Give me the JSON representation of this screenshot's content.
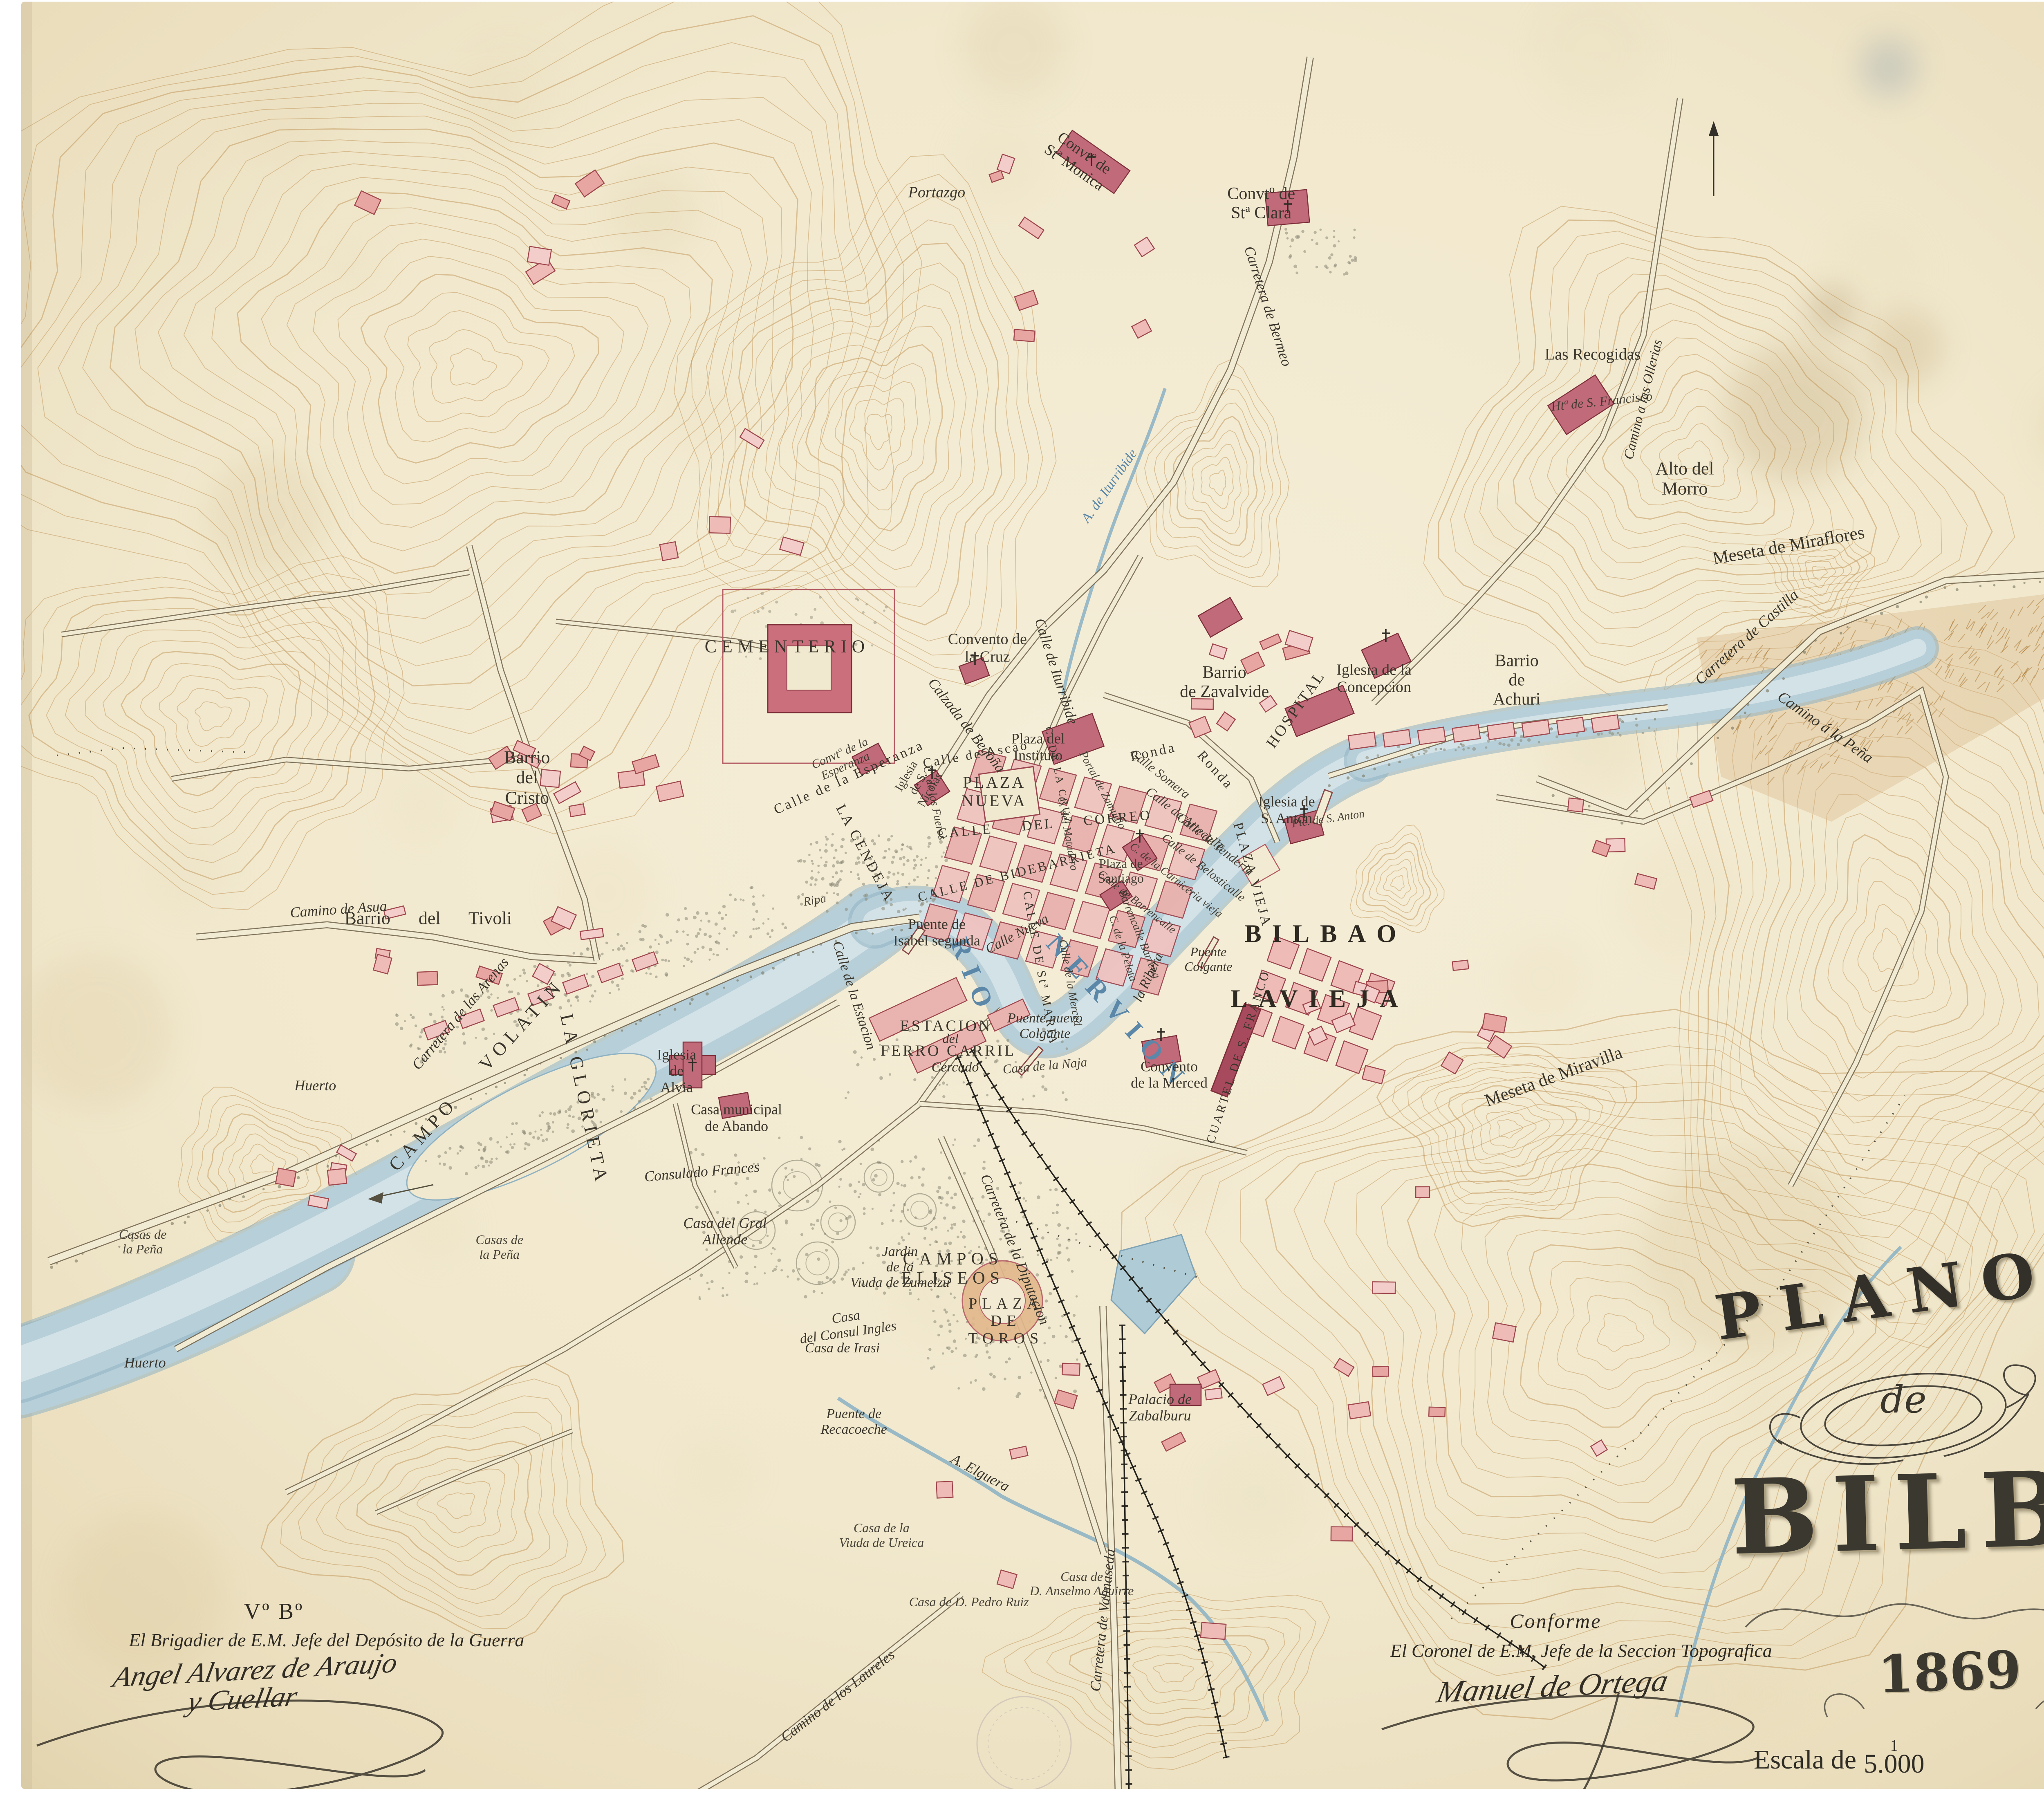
{
  "title_block": {
    "line1": "PLANO",
    "line2": "de",
    "line3": "BILBAO",
    "year": "1869"
  },
  "scale": {
    "label": "Escala de",
    "numerator": "1",
    "denominator": "5.000",
    "equidistance": "Equidistancia 3 Ms."
  },
  "approvals": {
    "left": {
      "visto_bueno": "Vº Bº",
      "role": "El Brigadier de E.M. Jefe del Depósito de la Guerra",
      "signature_line1": "Angel Alvarez de Araujo",
      "signature_line2": "y Cuellar"
    },
    "right": {
      "heading": "Conforme",
      "role": "El Coronel de E.M. Jefe de la Seccion Topografica",
      "signature": "Manuel de Ortega"
    }
  },
  "colors": {
    "paper": "#f1e9cf",
    "contour": "#bf9356",
    "water": "#b7cfd9",
    "building_light": "#f0c6c2",
    "building_dark": "#c06a7a",
    "ink": "#3a362c",
    "river_label": "#5b87a8"
  },
  "map_labels": [
    {
      "text": "CEMENTERIO",
      "x": 34.2,
      "y": 35.9,
      "rot": 0,
      "cls": "caps",
      "fs": 44
    },
    {
      "text": "Convento de\nla Cruz",
      "x": 42.9,
      "y": 36.0,
      "rot": 0,
      "cls": "roman",
      "fs": 38
    },
    {
      "text": "Calzada de Begoña",
      "x": 42.0,
      "y": 40.3,
      "rot": 52,
      "cls": "it",
      "fs": 36
    },
    {
      "text": "Calle de Iturribide",
      "x": 45.9,
      "y": 37.3,
      "rot": 72,
      "cls": "it",
      "fs": 36
    },
    {
      "text": "Barrio\nde Zavalvide",
      "x": 53.2,
      "y": 37.9,
      "rot": 0,
      "cls": "roman",
      "fs": 42
    },
    {
      "text": "Iglesia de la\nConcepcion",
      "x": 59.7,
      "y": 37.7,
      "rot": 0,
      "cls": "roman",
      "fs": 38
    },
    {
      "text": "HOSPITAL",
      "x": 56.3,
      "y": 39.4,
      "rot": -55,
      "cls": "caps-sm",
      "fs": 38
    },
    {
      "text": "Barrio\nde\nAchuri",
      "x": 65.9,
      "y": 37.8,
      "rot": 0,
      "cls": "roman",
      "fs": 42
    },
    {
      "text": "Carretera de Castilla",
      "x": 75.9,
      "y": 35.4,
      "rot": -42,
      "cls": "it",
      "fs": 38
    },
    {
      "text": "Camino á la Peña",
      "x": 79.3,
      "y": 40.4,
      "rot": 35,
      "cls": "it",
      "fs": 38
    },
    {
      "text": "Alto del\nMorro",
      "x": 73.2,
      "y": 26.6,
      "rot": 0,
      "cls": "roman",
      "fs": 44
    },
    {
      "text": "Meseta de Miraflores",
      "x": 77.7,
      "y": 30.3,
      "rot": -10,
      "cls": "roman",
      "fs": 44
    },
    {
      "text": "Meseta de Miravilla",
      "x": 67.5,
      "y": 59.8,
      "rot": -20,
      "cls": "roman",
      "fs": 44
    },
    {
      "text": "Las Recogidas",
      "x": 69.2,
      "y": 19.7,
      "rot": 0,
      "cls": "roman",
      "fs": 40
    },
    {
      "text": "Htª de S. Francisco",
      "x": 69.6,
      "y": 22.3,
      "rot": -6,
      "cls": "it-sm",
      "fs": 32
    },
    {
      "text": "Camino a las Ollerias",
      "x": 71.4,
      "y": 22.2,
      "rot": -76,
      "cls": "it",
      "fs": 34
    },
    {
      "text": "Convtº de\nStª Clara",
      "x": 54.8,
      "y": 11.3,
      "rot": 0,
      "cls": "roman",
      "fs": 42
    },
    {
      "text": "Convtº de\nStª Monica",
      "x": 46.9,
      "y": 8.9,
      "rot": 35,
      "cls": "roman",
      "fs": 38
    },
    {
      "text": "Portazgo",
      "x": 40.7,
      "y": 10.7,
      "rot": 0,
      "cls": "it",
      "fs": 38
    },
    {
      "text": "Carretera de Bermeo",
      "x": 55.1,
      "y": 17.0,
      "rot": 72,
      "cls": "it",
      "fs": 36
    },
    {
      "text": "Barrio\ndel\nCristo",
      "x": 22.9,
      "y": 43.2,
      "rot": 0,
      "cls": "roman",
      "fs": 44
    },
    {
      "text": "Camino de Asua",
      "x": 14.7,
      "y": 50.5,
      "rot": -4,
      "cls": "it",
      "fs": 36
    },
    {
      "text": "Barrio  del  Tivoli",
      "x": 18.6,
      "y": 51.0,
      "rot": 0,
      "cls": "roman spread",
      "fs": 44
    },
    {
      "text": "Huerto",
      "x": 13.7,
      "y": 60.3,
      "rot": 0,
      "cls": "it",
      "fs": 36
    },
    {
      "text": "Huerto",
      "x": 6.3,
      "y": 75.7,
      "rot": 0,
      "cls": "it",
      "fs": 36
    },
    {
      "text": "Casas de\nla Peña",
      "x": 6.2,
      "y": 69.0,
      "rot": 0,
      "cls": "it-sm",
      "fs": 32
    },
    {
      "text": "Casas de\nla Peña",
      "x": 21.7,
      "y": 69.3,
      "rot": 0,
      "cls": "it-sm",
      "fs": 32
    },
    {
      "text": "Carretera de las Arenas",
      "x": 20.0,
      "y": 56.3,
      "rot": -50,
      "cls": "it",
      "fs": 36
    },
    {
      "text": "CAMPO VOLATIN",
      "x": 20.7,
      "y": 59.7,
      "rot": -48,
      "cls": "caps spreadw",
      "fs": 46
    },
    {
      "text": "LA GLORIETA",
      "x": 25.4,
      "y": 61.1,
      "rot": 78,
      "cls": "caps",
      "fs": 46
    },
    {
      "text": "Iglesia\nde\nAlvia",
      "x": 29.4,
      "y": 59.5,
      "rot": 0,
      "cls": "roman",
      "fs": 36
    },
    {
      "text": "Consulado Frances",
      "x": 30.5,
      "y": 65.1,
      "rot": -5,
      "cls": "it",
      "fs": 36
    },
    {
      "text": "Casa municipal\nde Abando",
      "x": 32.0,
      "y": 62.1,
      "rot": 0,
      "cls": "roman",
      "fs": 36
    },
    {
      "text": "Casa del Gral\nAllende",
      "x": 31.5,
      "y": 68.4,
      "rot": 0,
      "cls": "it",
      "fs": 36
    },
    {
      "text": "Jardin\nde la\nViuda de Zumelzu",
      "x": 39.1,
      "y": 70.4,
      "rot": 0,
      "cls": "it",
      "fs": 34
    },
    {
      "text": "CAMPOS\nELISEOS",
      "x": 41.4,
      "y": 70.5,
      "rot": 0,
      "cls": "caps",
      "fs": 42
    },
    {
      "text": "Carretera de la Diputacion",
      "x": 44.1,
      "y": 69.4,
      "rot": 68,
      "cls": "it",
      "fs": 36
    },
    {
      "text": "PLAZA\nDE\nTOROS",
      "x": 43.7,
      "y": 73.4,
      "rot": 0,
      "cls": "caps",
      "fs": 38
    },
    {
      "text": "Casa\ndel Consul Ingles",
      "x": 36.8,
      "y": 73.6,
      "rot": -8,
      "cls": "it",
      "fs": 34
    },
    {
      "text": "Casa de Irasi",
      "x": 36.6,
      "y": 74.9,
      "rot": 0,
      "cls": "it",
      "fs": 34
    },
    {
      "text": "Puente de\nRecacoeche",
      "x": 37.1,
      "y": 79.0,
      "rot": 0,
      "cls": "it",
      "fs": 34
    },
    {
      "text": "A. Elguera",
      "x": 42.6,
      "y": 81.8,
      "rot": 28,
      "cls": "it",
      "fs": 36
    },
    {
      "text": "Palacio de\nZabalburu",
      "x": 50.4,
      "y": 78.2,
      "rot": 0,
      "cls": "it",
      "fs": 36
    },
    {
      "text": "Casa de la\nViuda de Ureica",
      "x": 38.3,
      "y": 85.3,
      "rot": 0,
      "cls": "it-sm",
      "fs": 32
    },
    {
      "text": "Casa de\nD. Anselmo Aguirre",
      "x": 47.0,
      "y": 88.0,
      "rot": 0,
      "cls": "it-sm",
      "fs": 32
    },
    {
      "text": "Casa de D. Pedro Ruiz",
      "x": 42.1,
      "y": 89.0,
      "rot": 0,
      "cls": "it-sm",
      "fs": 32
    },
    {
      "text": "Carretera de Valmaseda",
      "x": 47.9,
      "y": 90.0,
      "rot": -84,
      "cls": "it",
      "fs": 36
    },
    {
      "text": "Camino de los Laureles",
      "x": 36.4,
      "y": 94.2,
      "rot": -38,
      "cls": "it",
      "fs": 36
    },
    {
      "text": "BILBAO",
      "x": 57.6,
      "y": 51.9,
      "rot": 0,
      "cls": "caps-big",
      "fs": 62
    },
    {
      "text": "LA",
      "x": 54.7,
      "y": 55.5,
      "rot": 0,
      "cls": "caps-big",
      "fs": 62
    },
    {
      "text": "VIEJA",
      "x": 58.4,
      "y": 55.5,
      "rot": 0,
      "cls": "caps-big",
      "fs": 62
    },
    {
      "text": "RIO",
      "x": 42.3,
      "y": 54.3,
      "rot": 68,
      "cls": "blue",
      "fs": 66
    },
    {
      "text": "NERVION",
      "x": 48.6,
      "y": 56.3,
      "rot": 48,
      "cls": "blue",
      "fs": 66
    },
    {
      "text": "A. de Iturribide",
      "x": 48.2,
      "y": 27.0,
      "rot": -55,
      "cls": "blue-it",
      "fs": 34
    },
    {
      "text": "Puente de\nIsabel segunda",
      "x": 40.7,
      "y": 51.8,
      "rot": 0,
      "cls": "roman",
      "fs": 36
    },
    {
      "text": "Calle Nueva",
      "x": 44.2,
      "y": 51.9,
      "rot": -28,
      "cls": "it",
      "fs": 34
    },
    {
      "text": "CALLE DE Stª MARIA",
      "x": 45.2,
      "y": 53.8,
      "rot": 80,
      "cls": "caps-sm",
      "fs": 30
    },
    {
      "text": "Calle de la Merced",
      "x": 46.5,
      "y": 54.6,
      "rot": 80,
      "cls": "it-sm",
      "fs": 28
    },
    {
      "text": "C. de la Pelota",
      "x": 48.8,
      "y": 52.7,
      "rot": 72,
      "cls": "it-sm",
      "fs": 28
    },
    {
      "text": "Barrencalle Barrena",
      "x": 49.5,
      "y": 51.9,
      "rot": 68,
      "cls": "it-sm",
      "fs": 28
    },
    {
      "text": "la Ribera",
      "x": 49.9,
      "y": 54.3,
      "rot": -65,
      "cls": "it",
      "fs": 34
    },
    {
      "text": "Puente\nColgante",
      "x": 52.5,
      "y": 53.3,
      "rot": 0,
      "cls": "it",
      "fs": 32
    },
    {
      "text": "Puente nuevo\nColgante",
      "x": 45.4,
      "y": 57.0,
      "rot": 0,
      "cls": "it",
      "fs": 34
    },
    {
      "text": "Calle de la Estacion",
      "x": 37.1,
      "y": 55.3,
      "rot": 72,
      "cls": "it",
      "fs": 34
    },
    {
      "text": "ESTACION",
      "x": 41.1,
      "y": 57.0,
      "rot": 0,
      "cls": "caps-sm",
      "fs": 38
    },
    {
      "text": "del",
      "x": 41.3,
      "y": 57.7,
      "rot": 0,
      "cls": "it",
      "fs": 32
    },
    {
      "text": "FERRO CARRIL",
      "x": 41.2,
      "y": 58.4,
      "rot": 0,
      "cls": "caps-sm",
      "fs": 38
    },
    {
      "text": "Cercado",
      "x": 41.5,
      "y": 59.3,
      "rot": 0,
      "cls": "it",
      "fs": 34
    },
    {
      "text": "Casa de la Naja",
      "x": 45.4,
      "y": 59.2,
      "rot": -5,
      "cls": "it-sm",
      "fs": 32
    },
    {
      "text": "Convento\nde la Merced",
      "x": 50.8,
      "y": 59.7,
      "rot": 0,
      "cls": "roman",
      "fs": 36
    },
    {
      "text": "CUARTEL DE S. FRANCO",
      "x": 53.8,
      "y": 58.7,
      "rot": -72,
      "cls": "caps-sm",
      "fs": 30
    },
    {
      "text": "Ripa",
      "x": 35.4,
      "y": 50.0,
      "rot": -10,
      "cls": "it-sm",
      "fs": 30
    },
    {
      "text": "LA CENDEJA",
      "x": 37.6,
      "y": 47.4,
      "rot": 62,
      "cls": "caps-sm",
      "fs": 36
    },
    {
      "text": "PLAZA\nNUEVA",
      "x": 43.2,
      "y": 44.0,
      "rot": 0,
      "cls": "caps-sm",
      "fs": 40
    },
    {
      "text": "CALLE  DEL  CORREO",
      "x": 45.4,
      "y": 45.8,
      "rot": -5,
      "cls": "caps-sm spread",
      "fs": 34
    },
    {
      "text": "Calle de Ascao",
      "x": 42.4,
      "y": 41.9,
      "rot": -10,
      "cls": "caps-sm",
      "fs": 32
    },
    {
      "text": "Plaza del\nInstituto",
      "x": 45.1,
      "y": 41.5,
      "rot": 0,
      "cls": "roman",
      "fs": 36
    },
    {
      "text": "Ronda",
      "x": 50.1,
      "y": 41.8,
      "rot": -12,
      "cls": "caps-sm",
      "fs": 34
    },
    {
      "text": "Ronda",
      "x": 52.8,
      "y": 42.8,
      "rot": 48,
      "cls": "caps-sm",
      "fs": 34
    },
    {
      "text": "Calle Somera",
      "x": 50.4,
      "y": 43.0,
      "rot": 38,
      "cls": "it-sm",
      "fs": 32
    },
    {
      "text": "Calle de Artecalle",
      "x": 51.5,
      "y": 45.5,
      "rot": 38,
      "cls": "it-sm",
      "fs": 32
    },
    {
      "text": "Calle de Tenderia",
      "x": 52.8,
      "y": 46.9,
      "rot": 38,
      "cls": "it-sm",
      "fs": 32
    },
    {
      "text": "Calle de Belosticalle",
      "x": 52.3,
      "y": 48.2,
      "rot": 38,
      "cls": "it-sm",
      "fs": 30
    },
    {
      "text": "C. de la Carniceria vieja",
      "x": 51.1,
      "y": 48.9,
      "rot": 38,
      "cls": "it-sm",
      "fs": 28
    },
    {
      "text": "Calle de Barrencalle",
      "x": 49.4,
      "y": 50.1,
      "rot": 38,
      "cls": "it-sm",
      "fs": 28
    },
    {
      "text": "CALLE DE BIDEBARRIETA",
      "x": 44.2,
      "y": 48.5,
      "rot": -14,
      "cls": "caps-sm",
      "fs": 32
    },
    {
      "text": "Plaza de\nSantiago",
      "x": 48.7,
      "y": 48.4,
      "rot": 0,
      "cls": "roman-sm",
      "fs": 32
    },
    {
      "text": "PLAZA VIEJA",
      "x": 54.4,
      "y": 48.6,
      "rot": 74,
      "cls": "caps-sm",
      "fs": 34
    },
    {
      "text": "Iglesia de\nS. Anton",
      "x": 55.9,
      "y": 45.0,
      "rot": 0,
      "cls": "roman",
      "fs": 36
    },
    {
      "text": "Pte. de S. Anton",
      "x": 57.7,
      "y": 45.5,
      "rot": -8,
      "cls": "it-sm",
      "fs": 28
    },
    {
      "text": "Calle de la Esperanza",
      "x": 36.9,
      "y": 43.2,
      "rot": -24,
      "cls": "caps-sm",
      "fs": 34
    },
    {
      "text": "Convtº de la\nEsperanza",
      "x": 36.6,
      "y": 42.2,
      "rot": -24,
      "cls": "it-sm",
      "fs": 30
    },
    {
      "text": "Iglesia\nde S.\nNicolas",
      "x": 39.9,
      "y": 43.5,
      "rot": -60,
      "cls": "roman-sm",
      "fs": 30
    },
    {
      "text": "C. de los Fueros",
      "x": 40.6,
      "y": 44.6,
      "rot": 78,
      "cls": "it-sm",
      "fs": 28
    },
    {
      "text": "C. DE LA CRUZ",
      "x": 46.0,
      "y": 43.1,
      "rot": 78,
      "cls": "caps-sm",
      "fs": 26
    },
    {
      "text": "Portal de Zamudio",
      "x": 47.9,
      "y": 43.9,
      "rot": 62,
      "cls": "it-sm",
      "fs": 28
    },
    {
      "text": "C. del Matadero",
      "x": 46.4,
      "y": 46.3,
      "rot": 80,
      "cls": "it-sm",
      "fs": 28
    }
  ]
}
